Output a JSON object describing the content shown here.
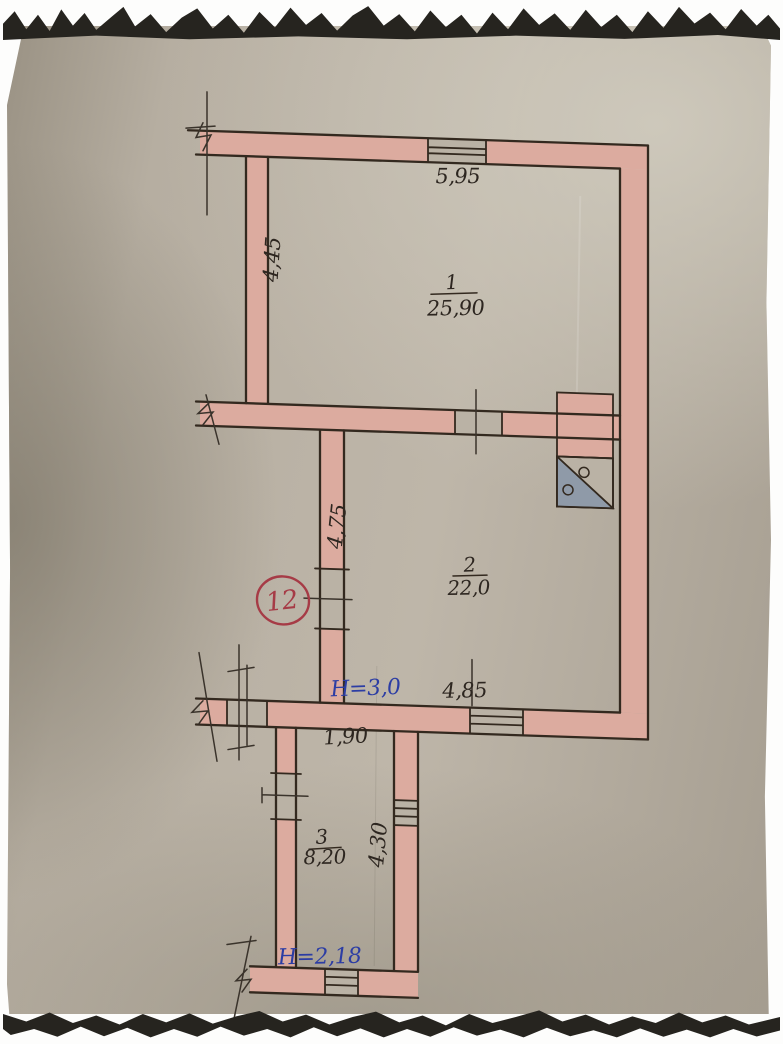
{
  "plan": {
    "badge": {
      "number": "12"
    },
    "rooms": [
      {
        "number": "1",
        "area": "25,90"
      },
      {
        "number": "2",
        "area": "22,0"
      },
      {
        "number": "3",
        "area": "8,20"
      }
    ],
    "dimensions": {
      "room1_width": "5,95",
      "room1_height": "4,45",
      "room2_height": "4,75",
      "room2_width": "4,85",
      "room2_ceiling": "H=3,0",
      "room3_width": "1,90",
      "room3_height": "4,30",
      "room3_ceiling": "H=2,18"
    },
    "icons": {
      "stove": "stove-symbol"
    },
    "colors": {
      "wall_fill": "#dcab9f",
      "opening_fill": "#bab2a5",
      "ink": "#33291f",
      "pencil": "#3a332b",
      "handwriting": "#2d2620",
      "blue_ink": "#2c3da4",
      "red_ink": "#a63b46",
      "stove_gray": "#8f9aa8"
    }
  }
}
